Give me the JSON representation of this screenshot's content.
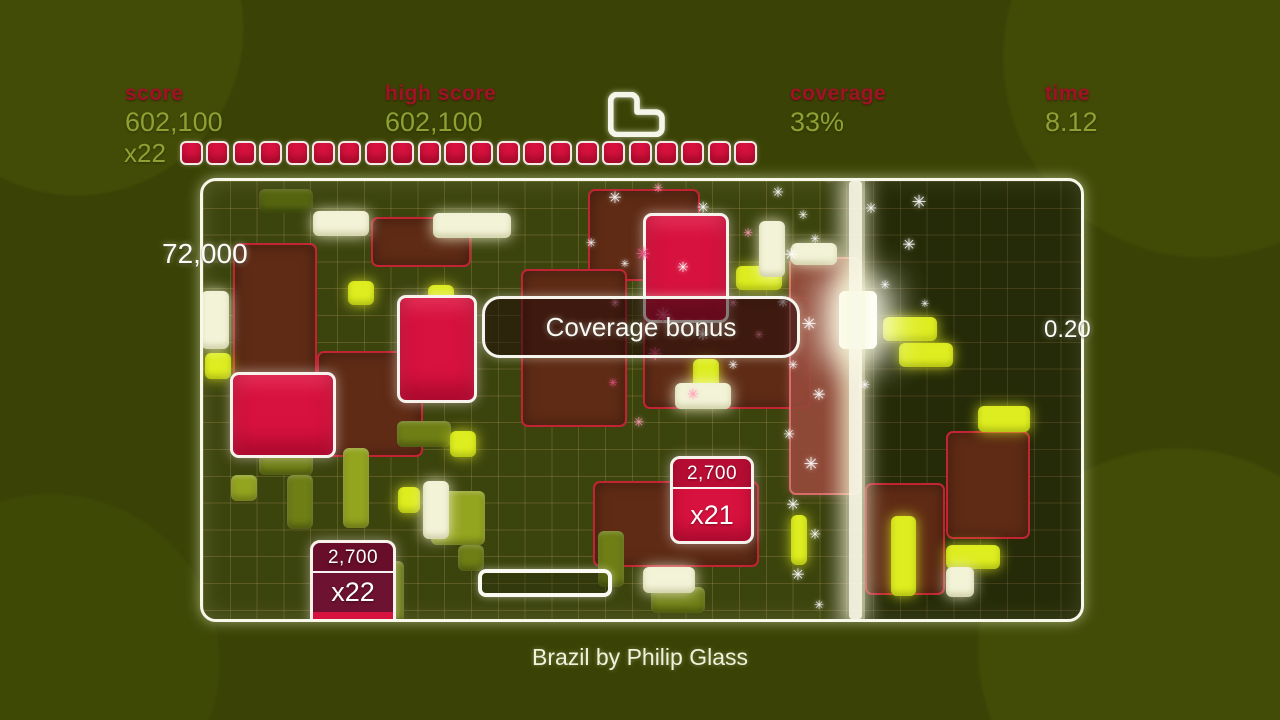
{
  "colors": {
    "label-red": "#a01225",
    "value-olive": "#8fa133",
    "crimson": "#d8123e",
    "maroon": "#5f2b15",
    "maroon-edge": "#c22433",
    "cream": "#f3f3d8",
    "yellow": "#dded1f",
    "white-soft": "#f7f3ec"
  },
  "hud": {
    "score": {
      "label": "score",
      "value": "602,100"
    },
    "high_score": {
      "label": "high score",
      "value": "602,100"
    },
    "coverage": {
      "label": "coverage",
      "value": "33%"
    },
    "time": {
      "label": "time",
      "value": "8.12"
    },
    "multiplier": {
      "label": "x22",
      "segments": 22
    }
  },
  "playfield": {
    "popup_left": "72,000",
    "popup_right": "0.20",
    "banner": "Coverage bonus",
    "sparkle_char": "✳",
    "sparkle_colors": {
      "w": "#ffffff",
      "p": "#ff9db8",
      "p2": "#e85585"
    },
    "score_blocks": [
      {
        "x": 667,
        "y": 453,
        "w": 84,
        "h": 88,
        "score": "2,700",
        "multiplier": "x21",
        "variant": ""
      },
      {
        "x": 307,
        "y": 537,
        "w": 86,
        "h": 88,
        "score": "2,700",
        "multiplier": "x22",
        "variant": "dark"
      }
    ],
    "blocks": [
      {
        "t": "maroon",
        "x": 230,
        "y": 240,
        "w": 84,
        "h": 214
      },
      {
        "t": "maroon",
        "x": 314,
        "y": 348,
        "w": 106,
        "h": 106
      },
      {
        "t": "maroon",
        "x": 368,
        "y": 214,
        "w": 100,
        "h": 50
      },
      {
        "t": "maroon",
        "x": 585,
        "y": 186,
        "w": 112,
        "h": 92
      },
      {
        "t": "maroon",
        "x": 518,
        "y": 266,
        "w": 106,
        "h": 158
      },
      {
        "t": "maroon",
        "x": 640,
        "y": 294,
        "w": 168,
        "h": 112
      },
      {
        "t": "maroon-lit",
        "x": 786,
        "y": 254,
        "w": 72,
        "h": 238
      },
      {
        "t": "maroon",
        "x": 862,
        "y": 480,
        "w": 80,
        "h": 112
      },
      {
        "t": "maroon",
        "x": 943,
        "y": 428,
        "w": 84,
        "h": 108
      },
      {
        "t": "maroon",
        "x": 590,
        "y": 478,
        "w": 166,
        "h": 86
      },
      {
        "t": "olive-dark",
        "x": 256,
        "y": 186,
        "w": 54,
        "h": 24
      },
      {
        "t": "olive",
        "x": 256,
        "y": 418,
        "w": 54,
        "h": 54
      },
      {
        "t": "olive-light",
        "x": 228,
        "y": 472,
        "w": 26,
        "h": 26
      },
      {
        "t": "olive",
        "x": 284,
        "y": 472,
        "w": 26,
        "h": 54
      },
      {
        "t": "olive-light",
        "x": 340,
        "y": 445,
        "w": 26,
        "h": 80
      },
      {
        "t": "olive",
        "x": 394,
        "y": 418,
        "w": 54,
        "h": 26
      },
      {
        "t": "olive-light",
        "x": 428,
        "y": 488,
        "w": 54,
        "h": 54
      },
      {
        "t": "olive",
        "x": 455,
        "y": 542,
        "w": 26,
        "h": 26
      },
      {
        "t": "olive",
        "x": 375,
        "y": 558,
        "w": 26,
        "h": 62
      },
      {
        "t": "olive",
        "x": 595,
        "y": 528,
        "w": 26,
        "h": 56
      },
      {
        "t": "olive",
        "x": 648,
        "y": 584,
        "w": 54,
        "h": 26
      },
      {
        "t": "yellow",
        "x": 202,
        "y": 350,
        "w": 26,
        "h": 26
      },
      {
        "t": "yellow",
        "x": 345,
        "y": 278,
        "w": 26,
        "h": 24
      },
      {
        "t": "yellow",
        "x": 425,
        "y": 282,
        "w": 26,
        "h": 24
      },
      {
        "t": "yellow",
        "x": 447,
        "y": 428,
        "w": 26,
        "h": 26
      },
      {
        "t": "yellow",
        "x": 690,
        "y": 356,
        "w": 26,
        "h": 40
      },
      {
        "t": "yellow",
        "x": 733,
        "y": 263,
        "w": 46,
        "h": 24
      },
      {
        "t": "yellow",
        "x": 880,
        "y": 314,
        "w": 54,
        "h": 24
      },
      {
        "t": "yellow",
        "x": 896,
        "y": 340,
        "w": 54,
        "h": 24
      },
      {
        "t": "yellow",
        "x": 975,
        "y": 403,
        "w": 52,
        "h": 26
      },
      {
        "t": "yellow",
        "x": 943,
        "y": 542,
        "w": 54,
        "h": 24
      },
      {
        "t": "yellow",
        "x": 888,
        "y": 513,
        "w": 25,
        "h": 80
      },
      {
        "t": "yellow",
        "x": 395,
        "y": 484,
        "w": 22,
        "h": 26
      },
      {
        "t": "yellow",
        "x": 788,
        "y": 512,
        "w": 16,
        "h": 50
      },
      {
        "t": "cream",
        "x": 310,
        "y": 208,
        "w": 56,
        "h": 25
      },
      {
        "t": "cream",
        "x": 430,
        "y": 210,
        "w": 78,
        "h": 25
      },
      {
        "t": "cream",
        "x": 198,
        "y": 288,
        "w": 28,
        "h": 58
      },
      {
        "t": "cream",
        "x": 756,
        "y": 218,
        "w": 26,
        "h": 56
      },
      {
        "t": "cream",
        "x": 788,
        "y": 240,
        "w": 46,
        "h": 22
      },
      {
        "t": "cream",
        "x": 672,
        "y": 380,
        "w": 56,
        "h": 26
      },
      {
        "t": "cream",
        "x": 420,
        "y": 478,
        "w": 26,
        "h": 58
      },
      {
        "t": "cream",
        "x": 943,
        "y": 564,
        "w": 28,
        "h": 30
      },
      {
        "t": "cream",
        "x": 640,
        "y": 564,
        "w": 52,
        "h": 26
      },
      {
        "t": "glow-white",
        "x": 836,
        "y": 288,
        "w": 38,
        "h": 58
      },
      {
        "t": "red",
        "x": 640,
        "y": 210,
        "w": 86,
        "h": 110
      },
      {
        "t": "red",
        "x": 394,
        "y": 292,
        "w": 80,
        "h": 108
      },
      {
        "t": "red",
        "x": 227,
        "y": 369,
        "w": 106,
        "h": 86
      }
    ],
    "sparkles": [
      [
        612,
        195,
        16,
        "w"
      ],
      [
        655,
        185,
        12,
        "p"
      ],
      [
        700,
        205,
        15,
        "w"
      ],
      [
        745,
        230,
        12,
        "p"
      ],
      [
        640,
        252,
        18,
        "p2"
      ],
      [
        680,
        265,
        14,
        "w"
      ],
      [
        612,
        300,
        12,
        "p"
      ],
      [
        660,
        312,
        20,
        "p2"
      ],
      [
        700,
        332,
        16,
        "w"
      ],
      [
        730,
        300,
        12,
        "p"
      ],
      [
        652,
        352,
        18,
        "p2"
      ],
      [
        690,
        392,
        14,
        "p"
      ],
      [
        622,
        262,
        10,
        "w"
      ],
      [
        588,
        240,
        12,
        "w"
      ],
      [
        730,
        362,
        12,
        "w"
      ],
      [
        756,
        332,
        11,
        "p"
      ],
      [
        636,
        420,
        13,
        "p"
      ],
      [
        610,
        380,
        11,
        "p2"
      ],
      [
        775,
        190,
        14,
        "w"
      ],
      [
        800,
        212,
        12,
        "w"
      ],
      [
        788,
        252,
        16,
        "w"
      ],
      [
        812,
        236,
        12,
        "w"
      ],
      [
        780,
        300,
        14,
        "w"
      ],
      [
        806,
        322,
        18,
        "w"
      ],
      [
        790,
        362,
        12,
        "w"
      ],
      [
        816,
        392,
        16,
        "w"
      ],
      [
        786,
        432,
        14,
        "w"
      ],
      [
        808,
        462,
        18,
        "w"
      ],
      [
        790,
        502,
        16,
        "w"
      ],
      [
        812,
        532,
        14,
        "w"
      ],
      [
        795,
        572,
        16,
        "w"
      ],
      [
        816,
        602,
        12,
        "w"
      ],
      [
        826,
        176,
        10,
        "w"
      ],
      [
        868,
        206,
        14,
        "w"
      ],
      [
        906,
        242,
        16,
        "w"
      ],
      [
        882,
        282,
        12,
        "w"
      ],
      [
        922,
        302,
        10,
        "w"
      ],
      [
        862,
        382,
        12,
        "w"
      ],
      [
        916,
        200,
        18,
        "w"
      ]
    ]
  },
  "footer": {
    "track": "Brazil by Philip Glass"
  }
}
